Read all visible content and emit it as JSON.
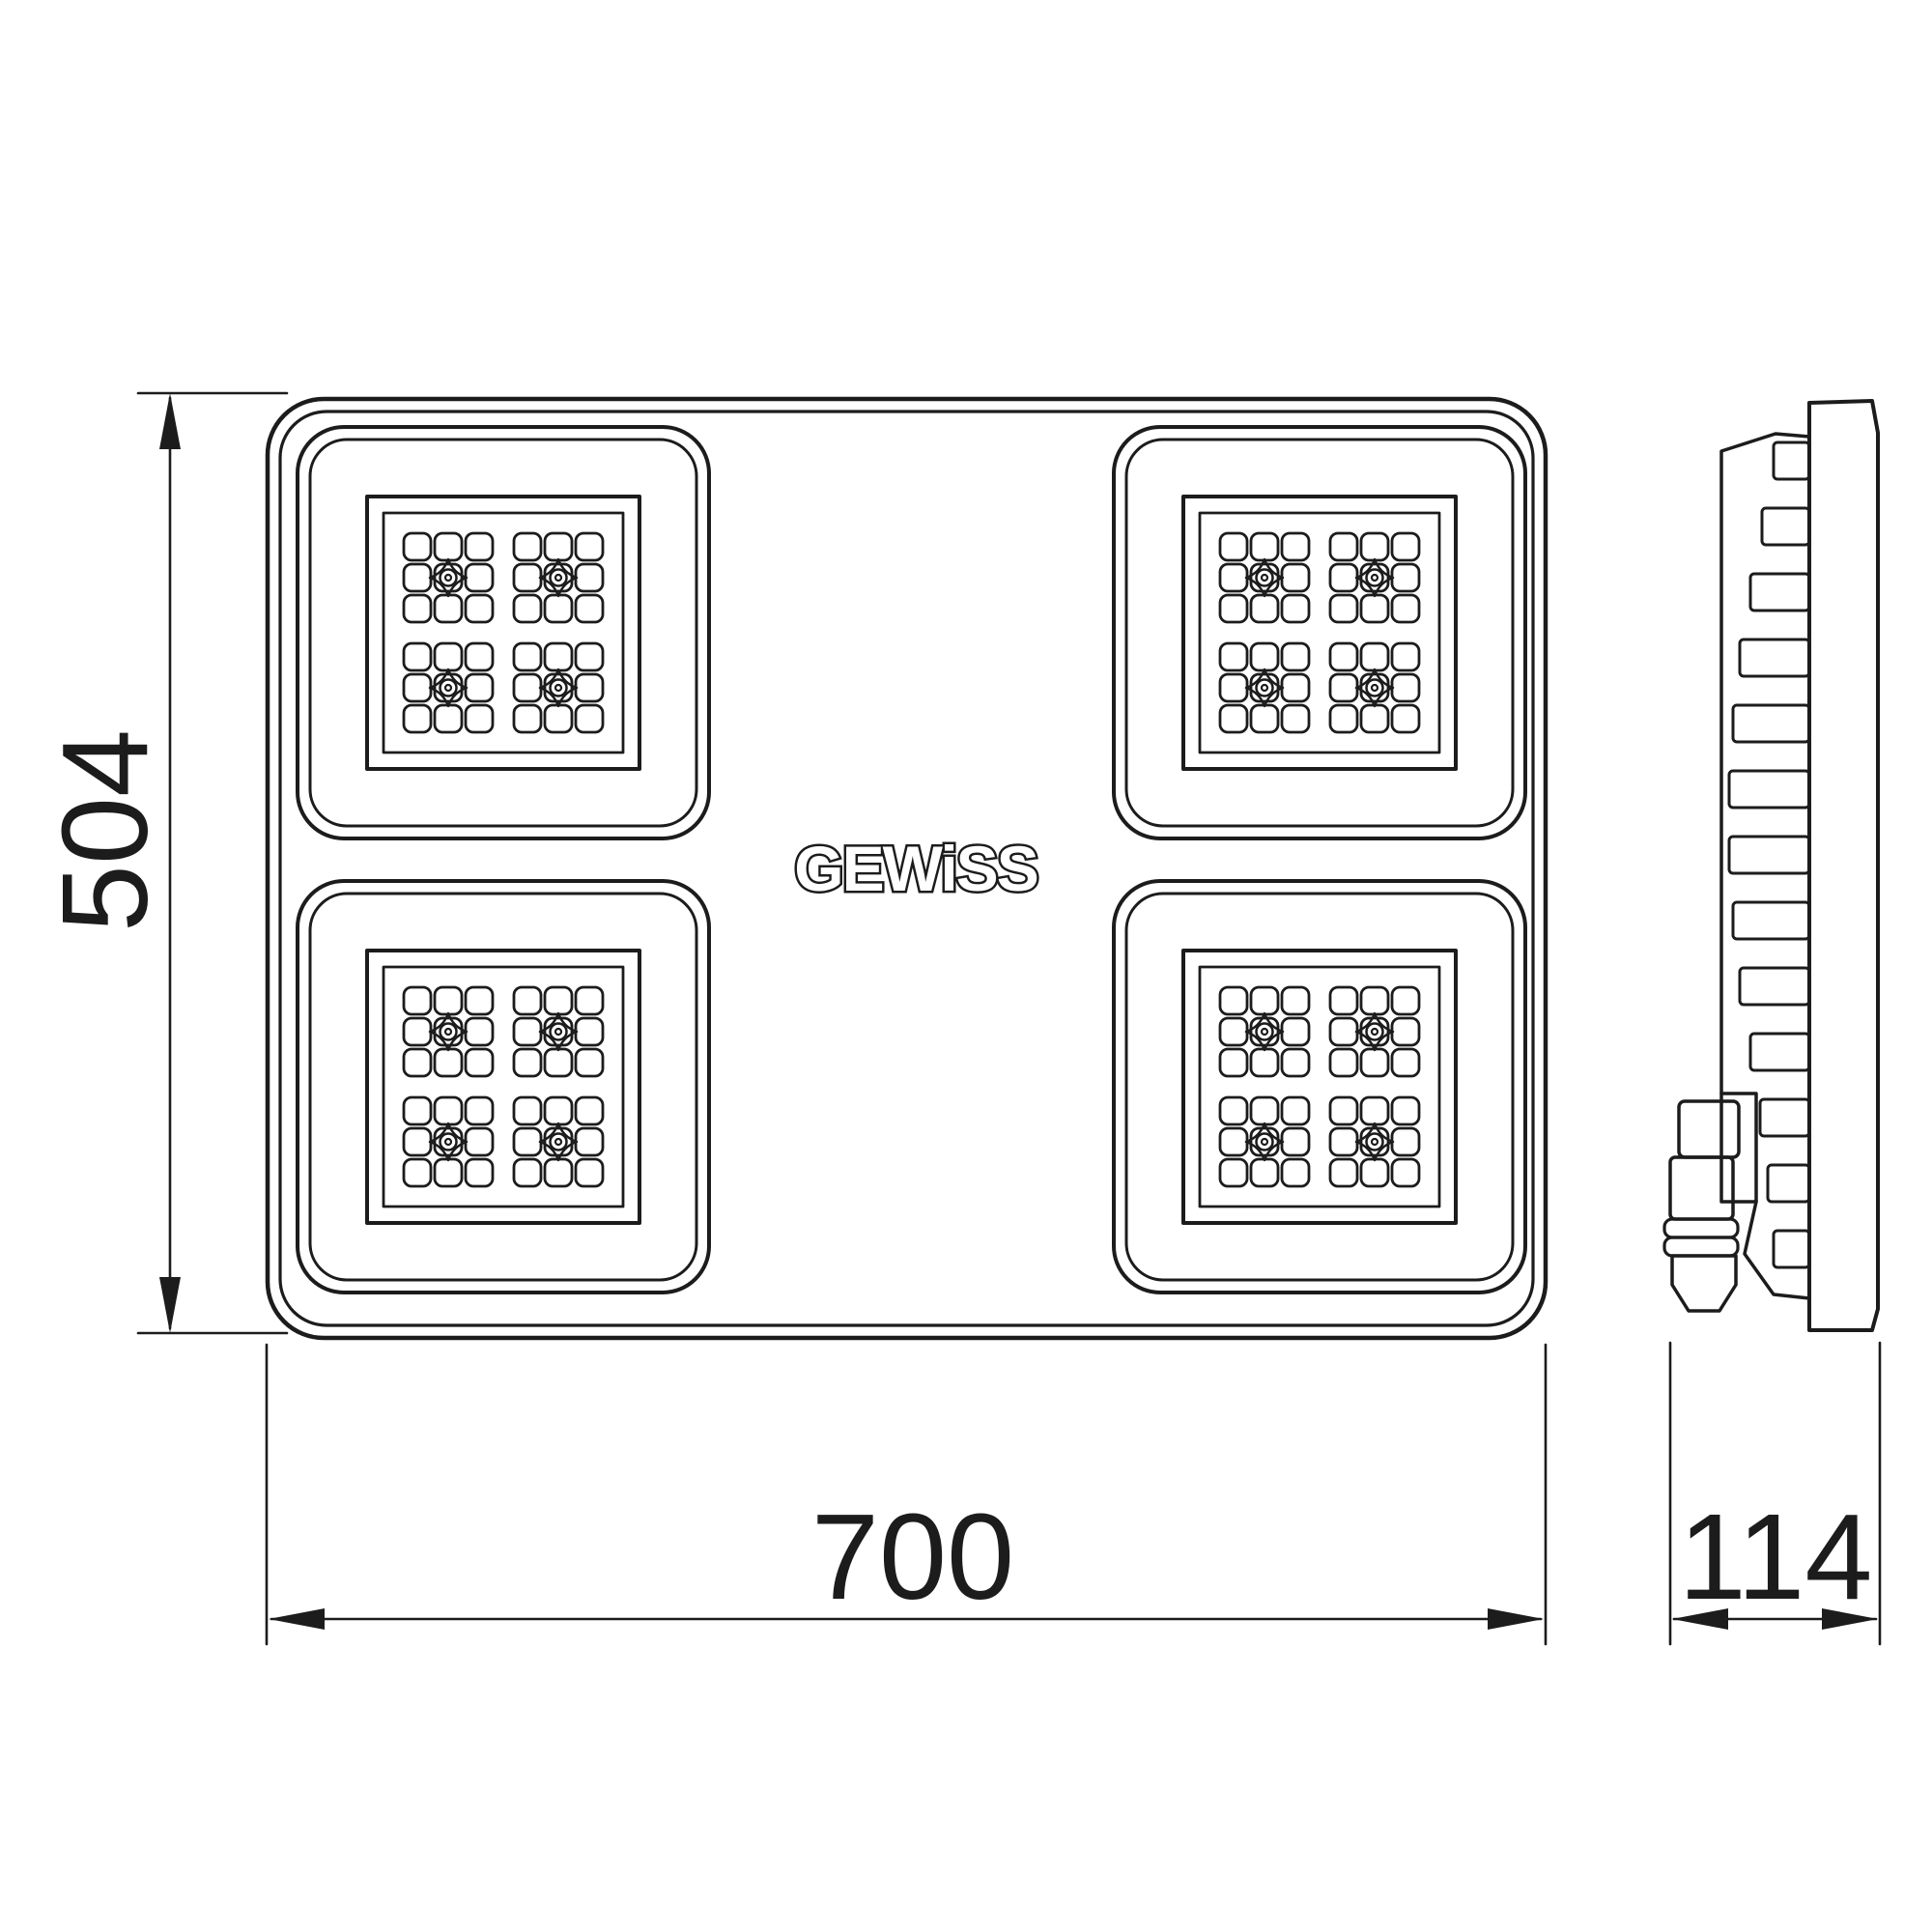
{
  "drawing": {
    "background_color": "#ffffff",
    "line_color": "#1c1c1c",
    "brand": {
      "logo_text": "GEWiSS"
    },
    "dimensions": {
      "height": {
        "label": "504"
      },
      "width": {
        "label": "700"
      },
      "depth": {
        "label": "114"
      }
    }
  }
}
